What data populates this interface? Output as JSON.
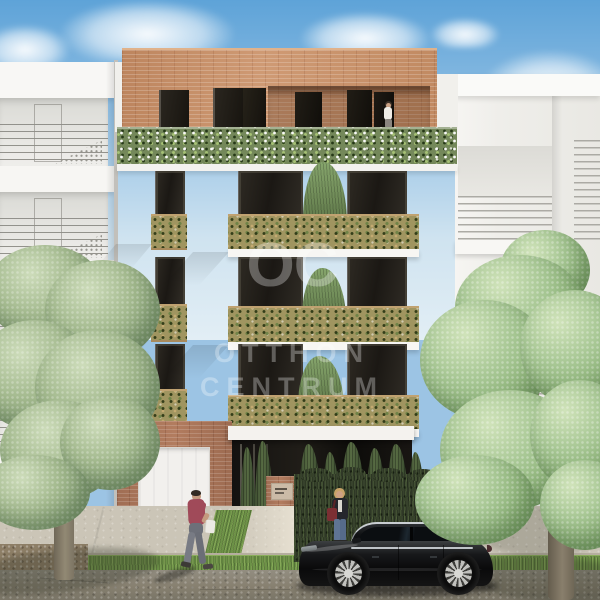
{
  "meta": {
    "description": "Photorealistic architectural street rendering: modern five-storey infill apartment house with brick penthouse, full-width ivy planter band and green planted balconies, flanked by two white balconied neighbour buildings; street with two trees, parked black sedan and three people",
    "visualization_style": "CGI real-estate rendering"
  },
  "watermark": {
    "logo": "OC",
    "line1": "OTTHON",
    "line2": "CENTRUM",
    "color": "#ffffff",
    "opacity": "0.30"
  },
  "palette": {
    "sky_top": "#5ea3d8",
    "sky_horizon": "#e2eef5",
    "facade_white": "#f3f2ef",
    "facade_shadow": "#d9d8d4",
    "brick_penthouse": "#c28b64",
    "brick_base": "#a6735a",
    "ivy_band_green": "#74885a",
    "balcony_planter": "#a09560",
    "planter_frame": "#c0a271",
    "window_glass": "#1b1814",
    "hedge": "#37422c",
    "cypress": "#46573a",
    "tree_left_foliage": "#a4ba8f",
    "tree_right_foliage": "#a6c693",
    "trunk": "#857c6b",
    "sidewalk": "#cbc5b7",
    "road_asphalt": "#8b8679",
    "grass_verge": "#6d9247",
    "car_body": "#0e0f10",
    "car_chrome": "#c3c8cc",
    "wheel_rim": "#c9c9c5",
    "man_shirt": "#a04a59",
    "woman_jacket": "#25262c",
    "woman_bag": "#7c2f33",
    "terrace_woman_top": "#efece6"
  },
  "scene": {
    "buildings": [
      {
        "name": "left-neighbour-building",
        "floors_visible": 4,
        "type": "white facade with recessed balconies and perforated parapets"
      },
      {
        "name": "main-building",
        "floors_visible": 5,
        "features": [
          "brick penthouse with roof terrace",
          "full-width ivy planter band",
          "three floors of green planter balconies with small conifers",
          "narrow side windows with planter boxes",
          "brick ground floor",
          "white garage door",
          "dark glazed entrance with canopy",
          "brick entrance pillar with nameplate",
          "brick garden wall"
        ]
      },
      {
        "name": "right-neighbour-building",
        "floors_visible": 3,
        "type": "white facade with projecting railed balconies"
      }
    ],
    "street": [
      "left street tree",
      "right street tree",
      "cypress and hedge front garden",
      "black sedan parked at curb",
      "concrete sidewalk",
      "grass verge",
      "asphalt road",
      "dirt strip"
    ],
    "people": [
      {
        "name": "man-walking",
        "detail": "dark-haired man in maroon shirt and grey jeans walking left carrying a white bag"
      },
      {
        "name": "woman-at-hedge",
        "detail": "blonde woman in dark jacket with red shoulder bag standing before the hedge"
      },
      {
        "name": "woman-on-terrace",
        "detail": "woman in white standing on the penthouse roof terrace"
      }
    ]
  }
}
